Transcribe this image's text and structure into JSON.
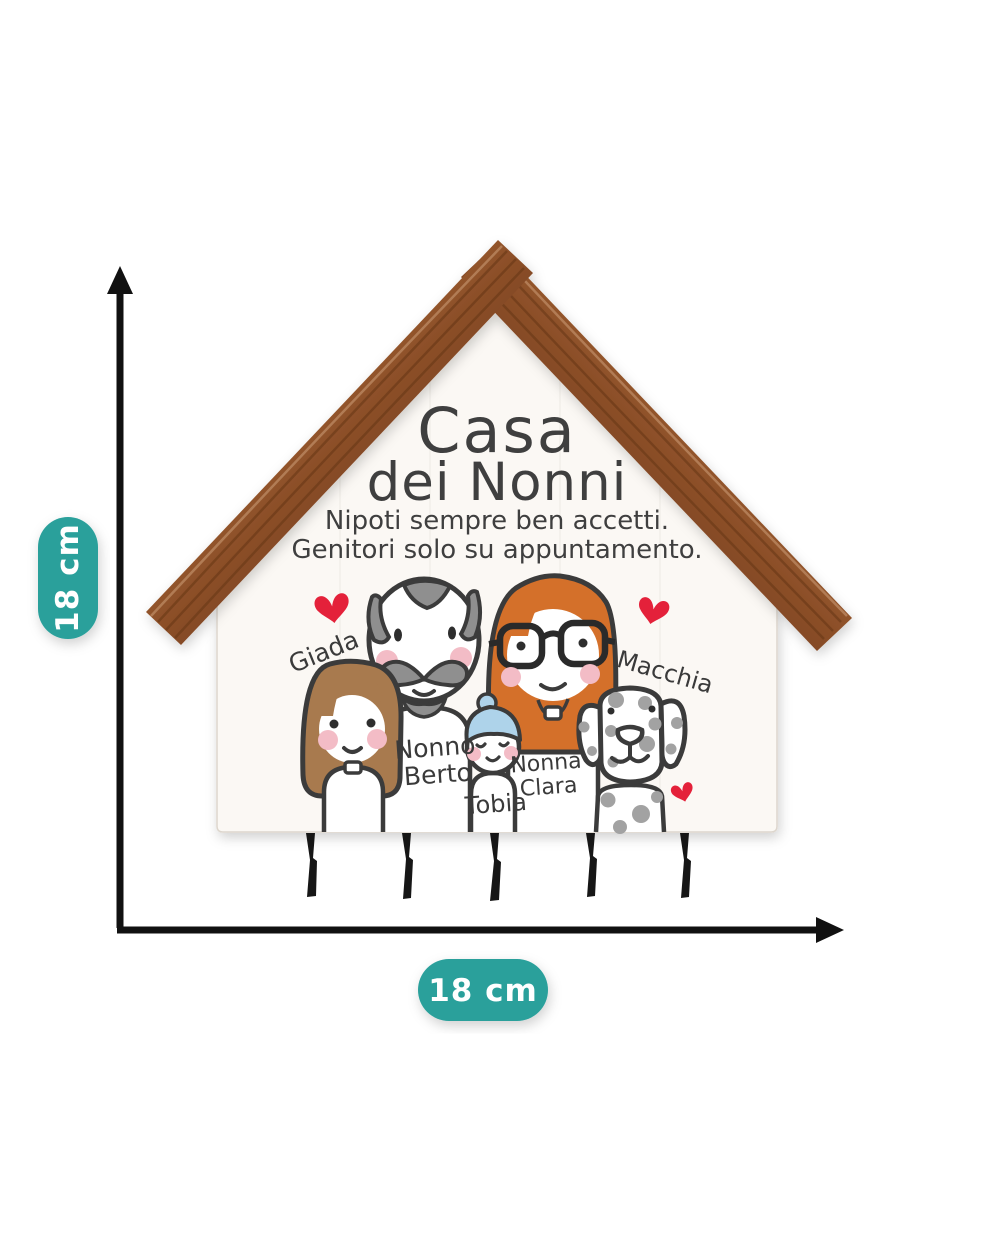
{
  "dimensions": {
    "height_label": "18 cm",
    "width_label": "18 cm"
  },
  "product": {
    "title_line1": "Casa",
    "title_line2": "dei Nonni",
    "subtitle_line1": "Nipoti sempre ben accetti.",
    "subtitle_line2": "Genitori solo su appuntamento.",
    "names": {
      "girl": "Giada",
      "grandpa_line1": "Nonno",
      "grandpa_line2": "Berto",
      "baby": "Tobia",
      "grandma_line1": "Nonna",
      "grandma_line2": "Clara",
      "dog": "Macchia"
    },
    "hook_count": 5
  },
  "colors": {
    "teal": "#2AA09B",
    "arrow_black": "#111111",
    "wood_light": "#C08552",
    "wood_base": "#9C5B2F",
    "wood_dark": "#6F3A1C",
    "board_white": "#FBF8F4",
    "line_dark": "#3B3B3B",
    "hair_brown": "#A87A4E",
    "hair_gray": "#8F8F8F",
    "hair_orange": "#D4702A",
    "beanie_blue": "#AED3EA",
    "blush_pink": "#F3BCC6",
    "spot_gray": "#A2A2A2",
    "heart_red": "#E4213A",
    "hook_black": "#161616"
  }
}
